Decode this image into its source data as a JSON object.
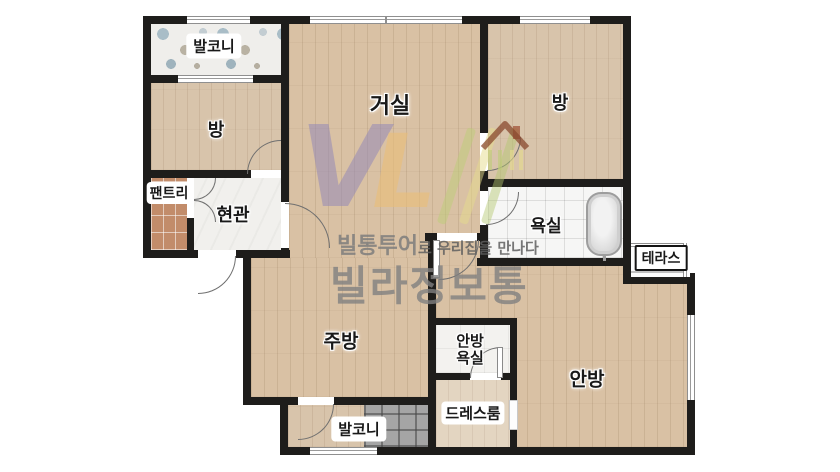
{
  "plan": {
    "rooms": {
      "balcony_top": "발코니",
      "room_left": "방",
      "living": "거실",
      "room_right": "방",
      "pantry": "팬트리",
      "entry": "현관",
      "bath": "욕실",
      "terrace": "테라스",
      "kitchen": "주방",
      "master_bath": "안방\n욕실",
      "dress_room": "드레스룸",
      "master": "안방",
      "balcony_bottom": "발코니"
    },
    "watermark": {
      "logo_v": "V",
      "logo_l": "L",
      "tagline_bold": "빌통투어",
      "tagline_rest": "로 우리집을 만나다",
      "brand": "빌라정보통"
    },
    "colors": {
      "wall": "#1e1d1b",
      "wood_floor": "#d9c1a4",
      "bath_tile": "#f6f6f5",
      "pantry_tile": "#c28c6a",
      "balcony_gray_tile": "#a5a5a5",
      "terrazzo": "#efeeeb",
      "watermark_purple": "#9488b6",
      "watermark_orange": "#e9be78",
      "watermark_green": "#becd78",
      "watermark_gray": "#808080"
    }
  }
}
